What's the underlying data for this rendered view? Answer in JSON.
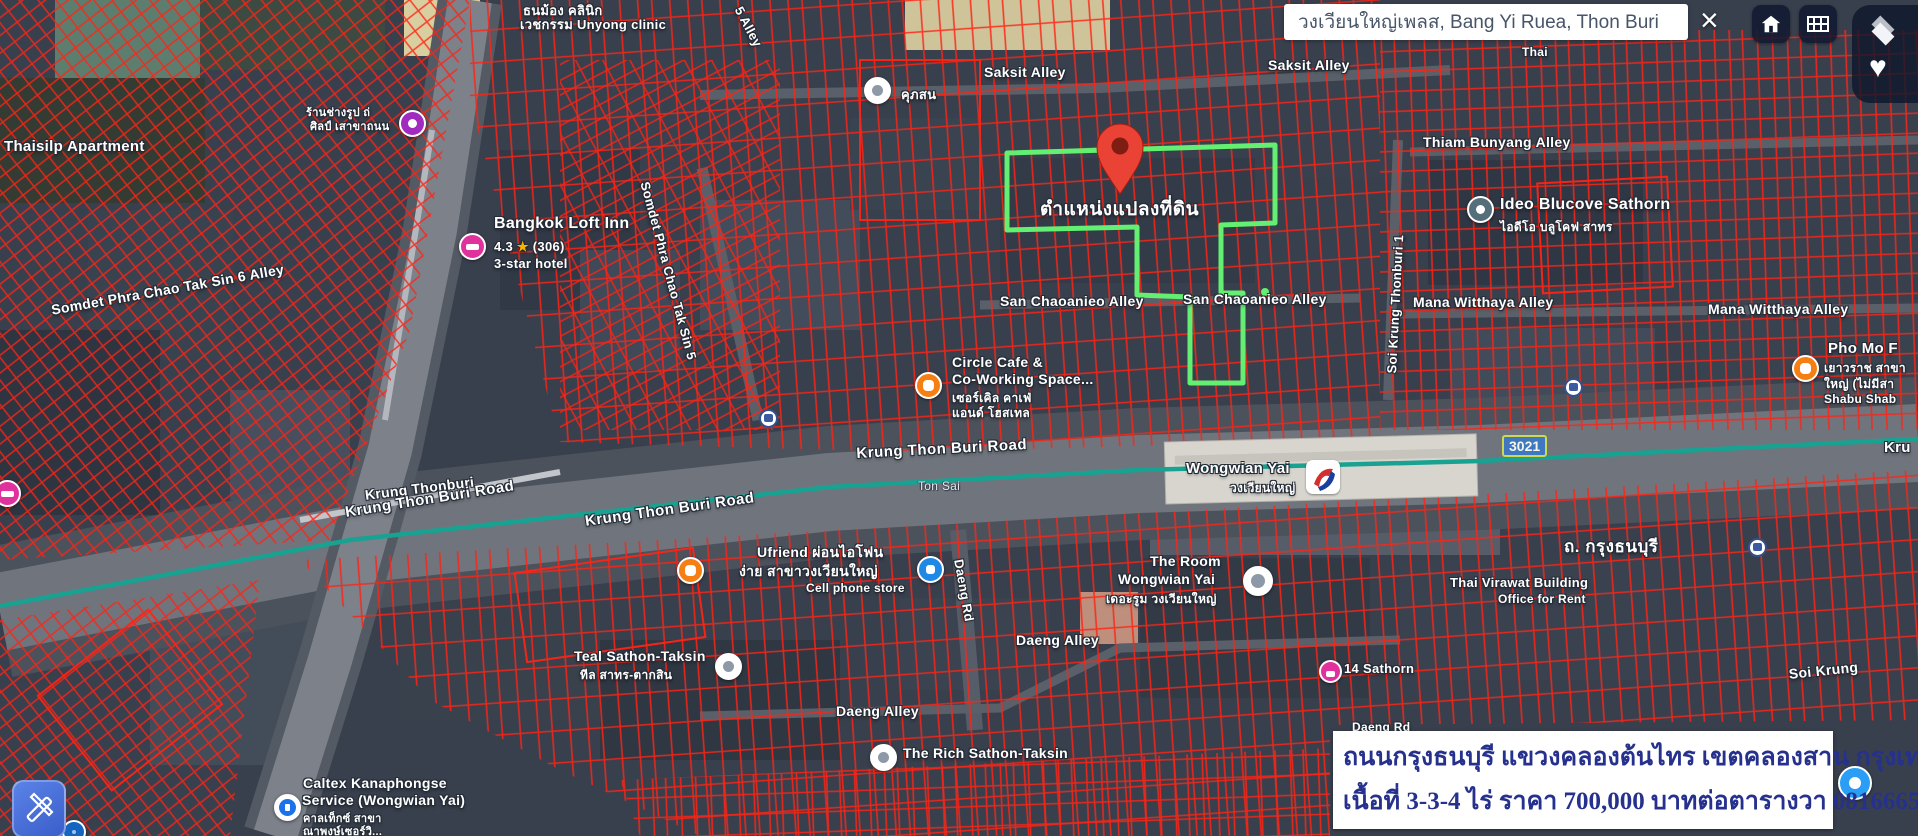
{
  "search_bar": {
    "value": "วงเวียนใหญ่เพลส, Bang Yi Ruea, Thon Buri"
  },
  "controls": {
    "close_glyph": "×",
    "favorite_glyph": "♥",
    "icons": {
      "home": "house-icon",
      "grid": "grid-icon",
      "layers": "layers-icon",
      "favorite": "heart-icon",
      "measure": "ruler-pencil-icon",
      "close": "close-x-icon"
    }
  },
  "route_badge": "3021",
  "pin": {
    "label": "ตำแหน่งแปลงที่ดิน"
  },
  "station": {
    "name": "Wongwian Yai",
    "name_th": "วงเวียนใหญ่"
  },
  "caption": {
    "line1": "ถนนกรุงธนบุรี  แขวงคลองต้นไทร  เขตคลองสาน กรุงเทพ",
    "line2": "เนื้อที่  3-3-4  ไร่  ราคา  700,000  บาทต่อตารางวา 0816665151"
  },
  "colors": {
    "parcel_outline": "#ff2415",
    "highlight_parcel": "#62ef72",
    "pin_red": "#ea4335",
    "bts_line": "#17a292",
    "caption_text": "#26318e",
    "badge_bg": "#3f78c0",
    "badge_border": "#cdd94e"
  },
  "streets": {
    "saksit_alley": "Saksit Alley",
    "thiam_bunyang_alley": "Thiam Bunyang Alley",
    "soi_krung_thonburi_1": "Soi Krung Thonburi 1",
    "mana_witthaya_alley": "Mana Witthaya Alley",
    "san_chaoanieo_alley": "San Chaoanieo Alley",
    "krung_thon_buri_road": "Krung Thon Buri Road",
    "krung_thonburi": "Krung Thonburi",
    "krung_fragment": "Kru",
    "thanon_krung_thonburi": "ถ. กรุงธนบุรี",
    "ton_sai": "Ton Sai",
    "daeng_rd": "Daeng Rd",
    "daeng_alley": "Daeng Alley",
    "somdet_tak_sin_6": "Somdet Phra Chao Tak Sin 6 Alley",
    "somdet_tak_sin_5": "Somdet Phra Chao Tak Sin 5",
    "five_alley": "5 Alley",
    "soi_krung_fragment": "Soi Krung",
    "thai_fragment": "Thai"
  },
  "pois": {
    "unyong_clinic": {
      "line1": "ธนม้อง คลินิก",
      "line2": "เวชกรรม Unyong clinic"
    },
    "thaisilp_apartment": {
      "name": "Thaisilp Apartment"
    },
    "photo_shop": {
      "line1": "ร้านช่างรูป ถ่",
      "line2": "ศิลป์ เสาขาถนน"
    },
    "khupason": {
      "name": "คุภสน"
    },
    "bangkok_loft_inn": {
      "name": "Bangkok Loft Inn",
      "rating": "4.3",
      "star": "★",
      "reviews": "(306)",
      "category": "3-star hotel"
    },
    "ideo_blucove": {
      "name": "Ideo Blucove Sathorn",
      "name_th": "ไอดีโอ บลูโคฟ สาทร"
    },
    "pho_mo": {
      "name": "Pho Mo F",
      "line_th1": "เยาวราช สาขา",
      "line_th2": "ใหญ่ (ไม่มีสา",
      "line2": "Shabu Shab"
    },
    "circle_cafe": {
      "line1": "Circle Cafe &",
      "line2": "Co-Working Space...",
      "line_th1": "เซอร์เคิล คาเฟ่",
      "line_th2": "แอนด์ โฮสเทล"
    },
    "ufriend": {
      "line1": "Ufriend ผ่อนไอโฟน",
      "line2": "ง่าย สาขาวงเวียนใหญ่",
      "line3": "Cell phone store"
    },
    "teal_sathon": {
      "name": "Teal Sathon-Taksin",
      "name_th": "ทีล สาทร-ตากสิน"
    },
    "the_rich": {
      "name": "The Rich Sathon-Taksin"
    },
    "the_room": {
      "line1": "The Room",
      "line2": "Wongwian Yai",
      "name_th": "เดอะรูม วงเวียนใหญ่"
    },
    "thai_virawat": {
      "line1": "Thai Virawat Building",
      "line2": "Office for Rent"
    },
    "fourteen_sathorn": {
      "name": "14 Sathorn"
    },
    "caltex": {
      "line1": "Caltex Kanaphongse",
      "line2": "Service (Wongwian Yai)",
      "line_th1": "คาลเท็กซ์ สาขา",
      "line_th2": "ณาพงษ์เซอร์วิ..."
    }
  }
}
